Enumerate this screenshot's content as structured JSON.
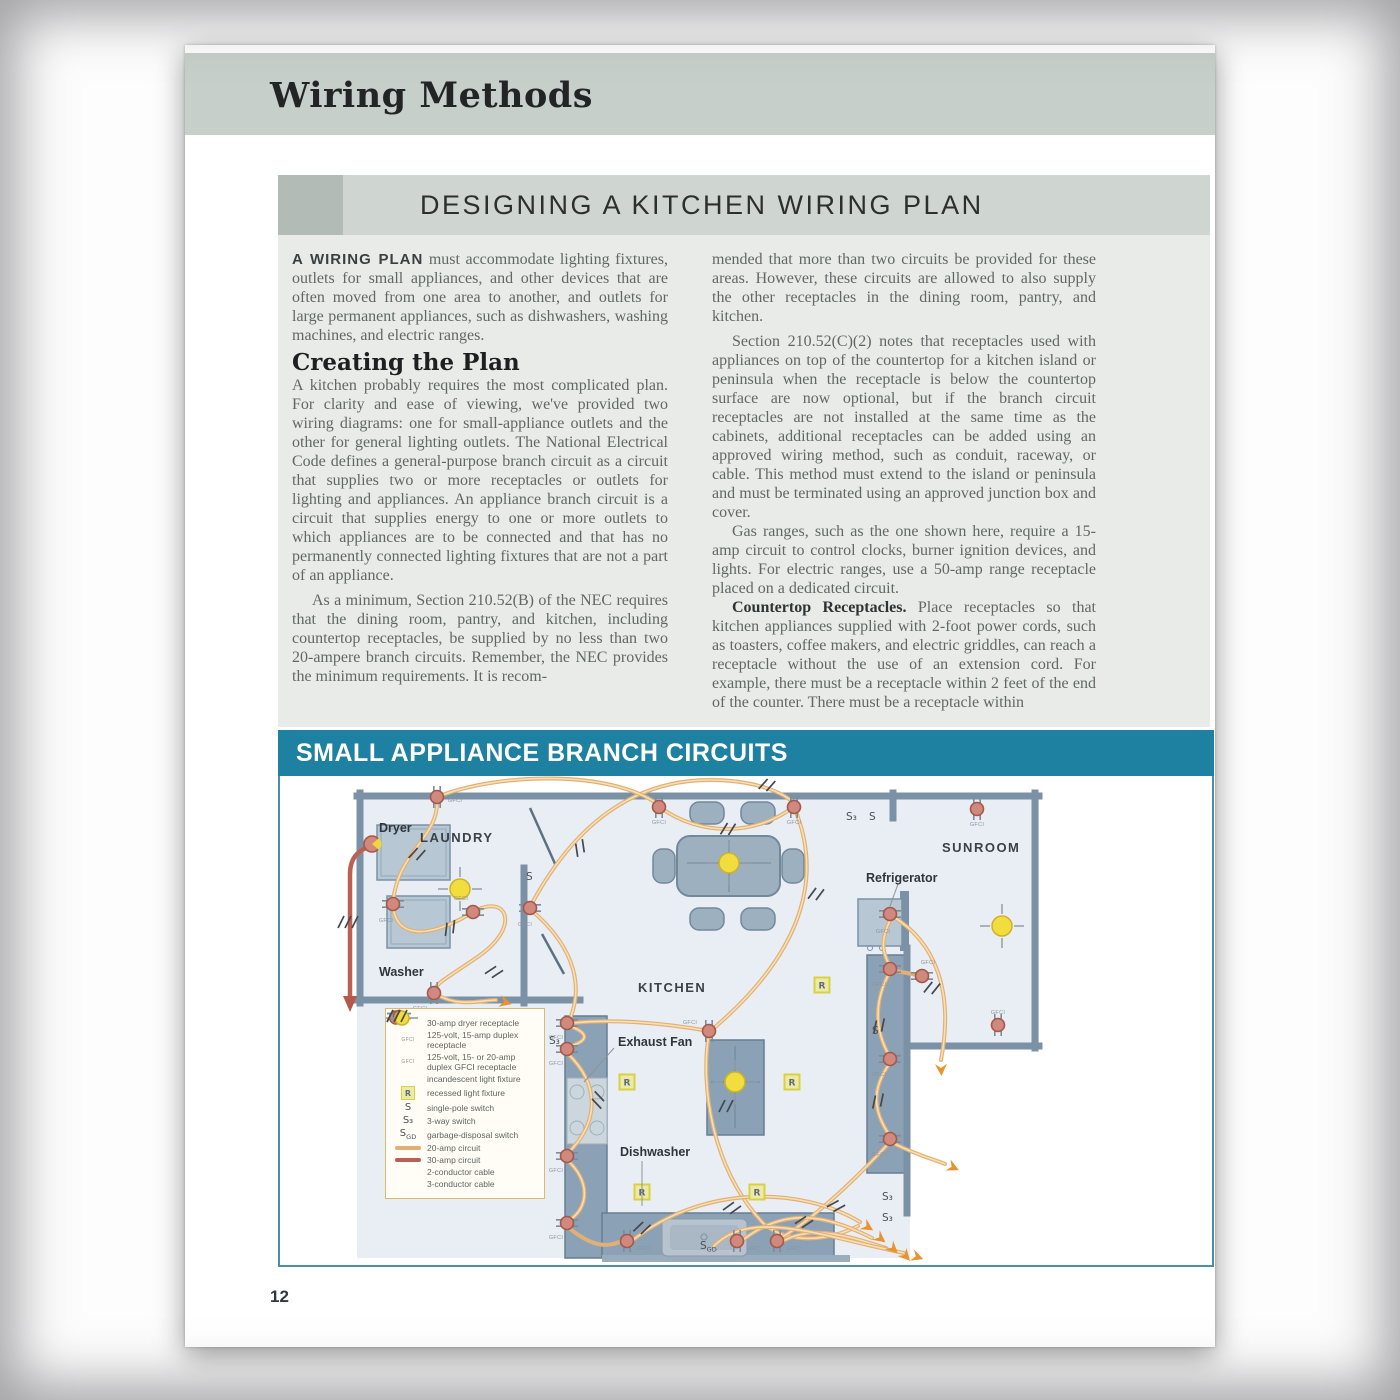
{
  "page": {
    "number": "12"
  },
  "header": {
    "title": "Wiring Methods"
  },
  "section": {
    "title": "DESIGNING A KITCHEN WIRING PLAN"
  },
  "article": {
    "p1_lead": "A WIRING PLAN",
    "p1_rest": " must accommodate lighting fixtures, outlets for small appliances, and other devices that are often moved from one area to another, and outlets for large permanent appliances, such as dishwashers, washing machines, and electric ranges.",
    "heading": "Creating the Plan",
    "p2": "A kitchen probably requires the most complicated plan. For clarity and ease of viewing, we've provided two wiring diagrams: one for small-appliance outlets and the other for general lighting outlets. The National Electrical Code defines a general-purpose branch circuit as a circuit that supplies two or more receptacles or outlets for lighting and appliances. An appliance branch circuit is a circuit that supplies energy to one or more outlets to which appliances are to be connected and that has no permanently connected lighting fixtures that are not a part of an appliance.",
    "p3": "As a minimum, Section 210.52(B) of the NEC requires that the dining room, pantry, and kitchen, including countertop receptacles, be supplied by no less than two 20-ampere branch circuits. Remember, the NEC provides the minimum requirements. It is recom-",
    "p4": "mended that more than two circuits be provided for these areas. However, these circuits are allowed to also supply the other receptacles in the dining room, pantry, and kitchen.",
    "p5": "Section 210.52(C)(2) notes that receptacles used with appliances on top of the countertop for a kitchen island or peninsula when the receptacle is below the countertop surface are now optional, but if the branch circuit receptacles are not installed at the same time as the cabinets, additional receptacles can be added using an approved wiring method, such as conduit, raceway, or cable. This method must extend to the island or peninsula and must be terminated using an approved junction box and cover.",
    "p6": "Gas ranges, such as the one shown here, require a 15-amp circuit to control clocks, burner ignition devices, and lights. For electric ranges, use a 50-amp range receptacle placed on a dedicated circuit.",
    "p7_lead": "Countertop Receptacles.",
    "p7_rest": " Place receptacles so that kitchen appliances supplied with 2-foot power cords, such as toasters, coffee makers, and electric griddles, can reach a receptacle without the use of an extension cord. For example, there must be a receptacle within 2 feet of the end of the counter. There must be a receptacle within"
  },
  "diagram": {
    "banner": "SMALL APPLIANCE BRANCH CIRCUITS",
    "rooms": {
      "laundry": "LAUNDRY",
      "kitchen": "KITCHEN",
      "sunroom": "SUNROOM"
    },
    "labels": {
      "dryer": "Dryer",
      "washer": "Washer",
      "refrigerator": "Refrigerator",
      "exhaust_fan": "Exhaust Fan",
      "dishwasher": "Dishwasher"
    },
    "gfci": "GFCI",
    "r": "R",
    "s": "S",
    "s3": "S₃",
    "sgd_s": "S",
    "sgd_sub": "GD",
    "colors": {
      "banner_teal": "#1f81a1",
      "circuit_20amp": "#e2b076",
      "circuit_30amp": "#bd6054",
      "receptacle": "#d0897c",
      "light": "#f2dd3f",
      "wall": "#7b92a6"
    }
  },
  "legend": {
    "items": [
      {
        "sym": "dryer-receptacle",
        "label": "30-amp dryer receptacle"
      },
      {
        "sym": "duplex-receptacle",
        "label": "125-volt, 15-amp duplex receptacle"
      },
      {
        "sym": "gfci-receptacle",
        "label": "125-volt, 15- or 20-amp duplex GFCI receptacle"
      },
      {
        "sym": "incandescent-light",
        "label": "incandescent light fixture"
      },
      {
        "sym": "recessed-light",
        "label": "recessed light fixture"
      },
      {
        "sym": "single-pole-switch",
        "label": "single-pole switch"
      },
      {
        "sym": "three-way-switch",
        "label": "3-way switch"
      },
      {
        "sym": "garbage-disposal-switch",
        "label": "garbage-disposal switch"
      },
      {
        "sym": "20-amp-circuit",
        "label": "20-amp circuit"
      },
      {
        "sym": "30-amp-circuit",
        "label": "30-amp circuit"
      },
      {
        "sym": "2-conductor-cable",
        "label": "2-conductor cable"
      },
      {
        "sym": "3-conductor-cable",
        "label": "3-conductor cable"
      }
    ]
  }
}
